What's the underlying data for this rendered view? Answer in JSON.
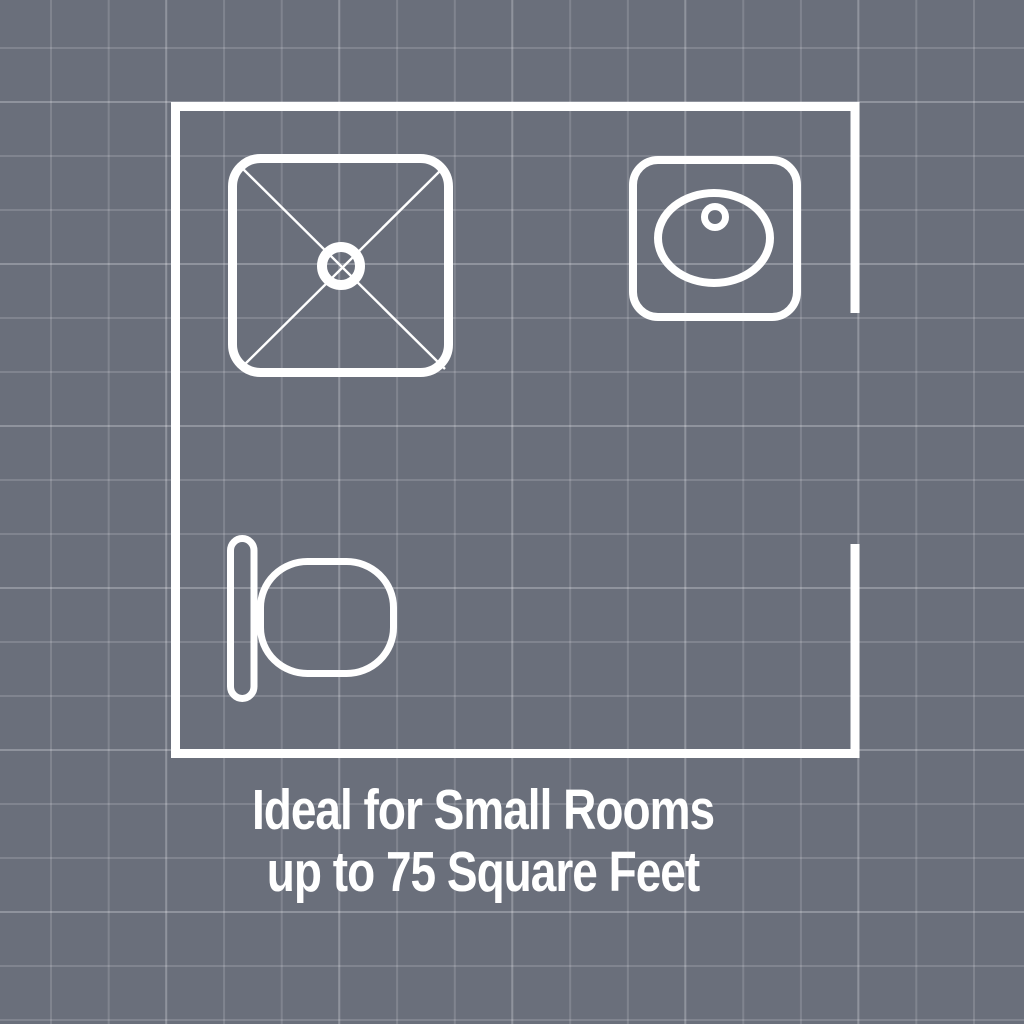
{
  "colors": {
    "background": "#6a6f7b",
    "grid_minor": "rgba(255,255,255,0.15)",
    "grid_major": "rgba(255,255,255,0.12)",
    "line": "#ffffff",
    "text": "#ffffff"
  },
  "floor_plan": {
    "kind": "bathroom-floor-plan",
    "fixtures": [
      {
        "name": "shower",
        "position": "top-left"
      },
      {
        "name": "sink",
        "position": "top-right"
      },
      {
        "name": "toilet",
        "position": "bottom-left"
      }
    ],
    "door_opening": "right-wall"
  },
  "caption": {
    "line1": "Ideal for Small Rooms",
    "line2": "up to 75 Square Feet"
  }
}
